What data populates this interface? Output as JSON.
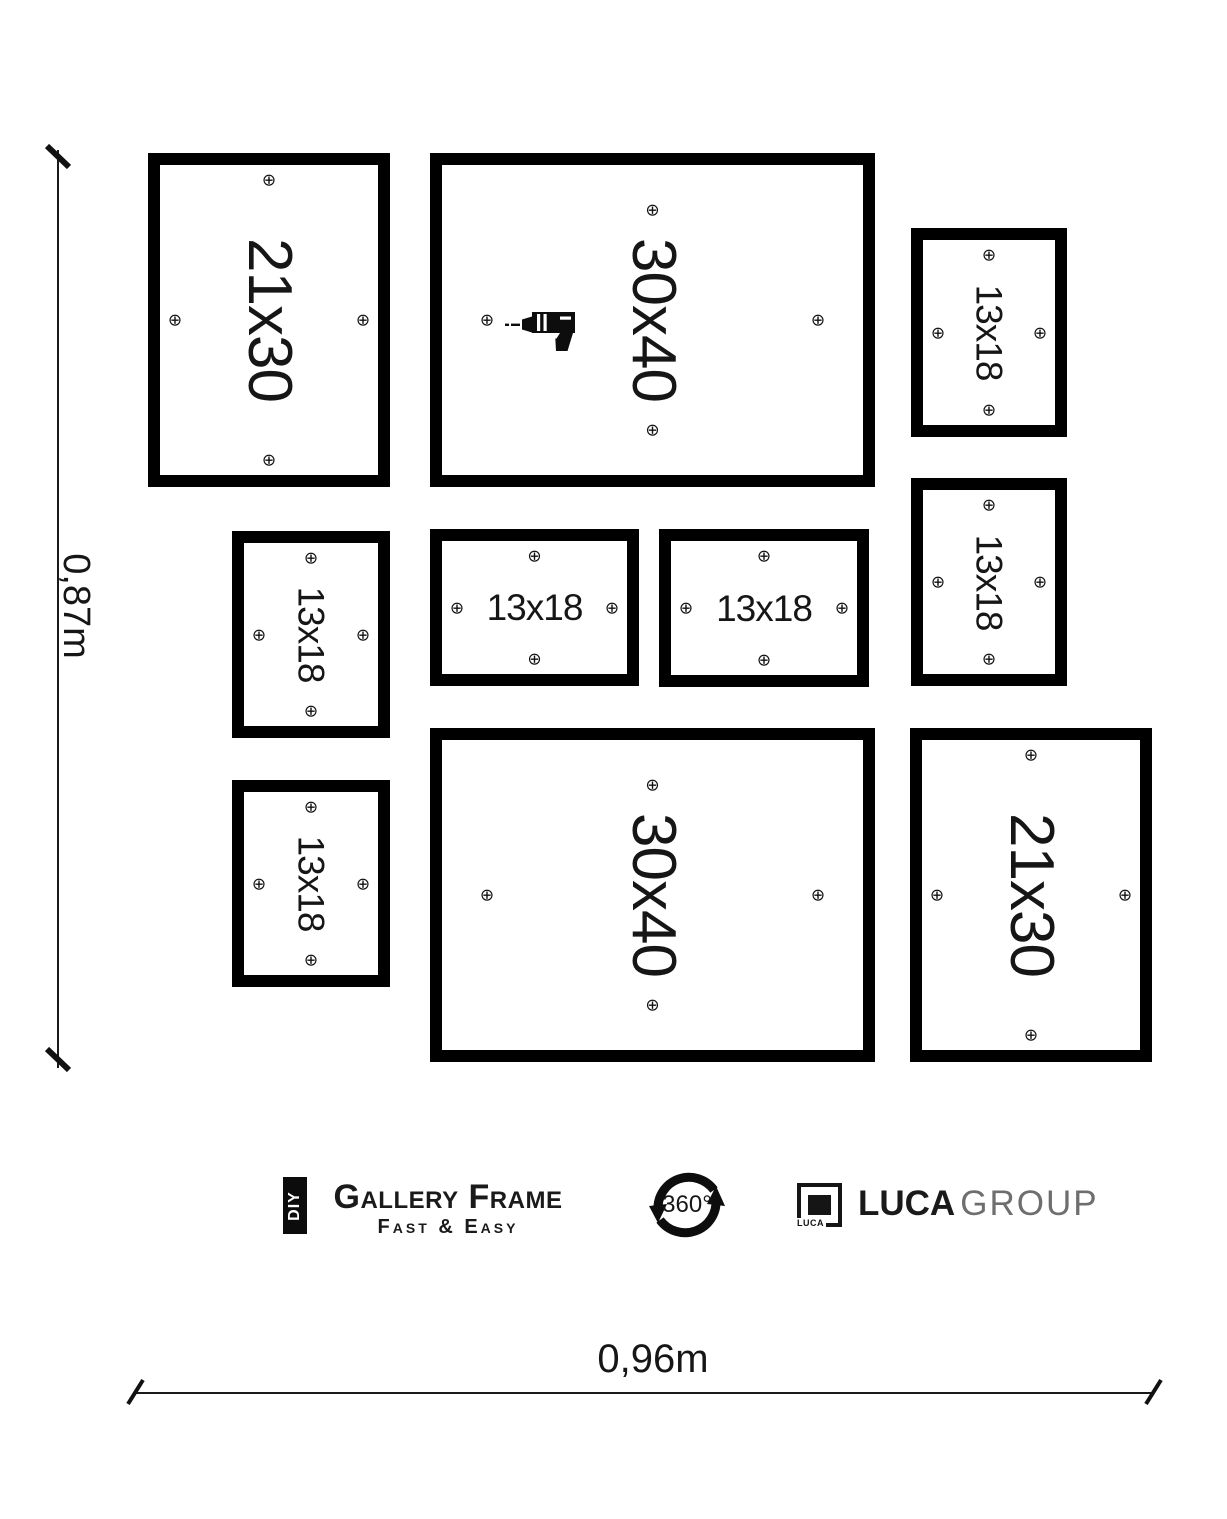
{
  "canvas": {
    "width": 1227,
    "height": 1519,
    "background": "#ffffff",
    "ink": "#000000",
    "gray": "#6e6e6e"
  },
  "icons": {
    "screw_symbol": "⊕",
    "drill": "drill-icon",
    "rotation": "circular-arrows-icon"
  },
  "frames": [
    {
      "id": "frame-21x30-top-left",
      "label": "21x30",
      "x": 148,
      "y": 153,
      "w": 242,
      "h": 334,
      "rotated": true,
      "label_size": 62,
      "screw_offset": 27,
      "drill": false
    },
    {
      "id": "frame-30x40-top-center",
      "label": "30x40",
      "x": 430,
      "y": 153,
      "w": 445,
      "h": 334,
      "rotated": true,
      "label_size": 62,
      "screw_offset": 57,
      "drill": true
    },
    {
      "id": "frame-13x18-top-right",
      "label": "13x18",
      "x": 911,
      "y": 228,
      "w": 156,
      "h": 209,
      "rotated": true,
      "label_size": 37,
      "screw_offset": 27,
      "drill": false
    },
    {
      "id": "frame-13x18-mid-left",
      "label": "13x18",
      "x": 232,
      "y": 531,
      "w": 158,
      "h": 207,
      "rotated": true,
      "label_size": 37,
      "screw_offset": 27,
      "drill": false
    },
    {
      "id": "frame-13x18-mid-center-1",
      "label": "13x18",
      "x": 430,
      "y": 529,
      "w": 209,
      "h": 157,
      "rotated": false,
      "label_size": 37,
      "screw_offset": 27,
      "drill": false
    },
    {
      "id": "frame-13x18-mid-center-2",
      "label": "13x18",
      "x": 659,
      "y": 529,
      "w": 210,
      "h": 158,
      "rotated": false,
      "label_size": 37,
      "screw_offset": 27,
      "drill": false
    },
    {
      "id": "frame-13x18-mid-right",
      "label": "13x18",
      "x": 911,
      "y": 478,
      "w": 156,
      "h": 208,
      "rotated": true,
      "label_size": 37,
      "screw_offset": 27,
      "drill": false
    },
    {
      "id": "frame-13x18-bottom-left",
      "label": "13x18",
      "x": 232,
      "y": 780,
      "w": 158,
      "h": 207,
      "rotated": true,
      "label_size": 37,
      "screw_offset": 27,
      "drill": false
    },
    {
      "id": "frame-30x40-bottom-center",
      "label": "30x40",
      "x": 430,
      "y": 728,
      "w": 445,
      "h": 334,
      "rotated": true,
      "label_size": 62,
      "screw_offset": 57,
      "drill": false
    },
    {
      "id": "frame-21x30-bottom-right",
      "label": "21x30",
      "x": 910,
      "y": 728,
      "w": 242,
      "h": 334,
      "rotated": true,
      "label_size": 62,
      "screw_offset": 27,
      "drill": false
    }
  ],
  "dimensions": {
    "vertical": {
      "label": "0,87m"
    },
    "horizontal": {
      "label": "0,96m"
    }
  },
  "footer": {
    "diy_badge": "DIY",
    "brand_title": "Gallery Frame",
    "brand_subtitle": "Fast & Easy",
    "rotation_label": "360°",
    "luca_logo_label": "LUCA",
    "luca_brand": "LUCA",
    "luca_brand_suffix": "GROUP"
  }
}
